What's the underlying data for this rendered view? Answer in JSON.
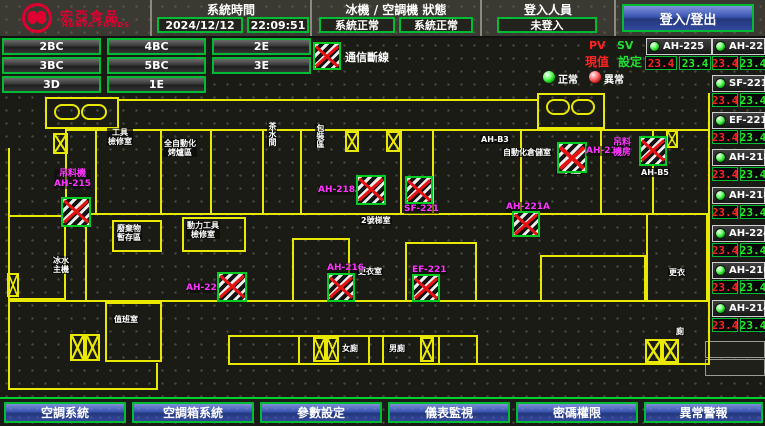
{
  "header": {
    "brand": {
      "name": "宏亞食品",
      "subname": "HUNYA FOODS"
    },
    "time": {
      "label": "系統時間",
      "date": "2024/12/12",
      "clock": "22:09:51"
    },
    "status": {
      "label": "冰機 / 空調機 狀態",
      "chiller": "系統正常",
      "ahu": "系統正常"
    },
    "login": {
      "label": "登入人員",
      "user": "未登入",
      "button_label": "登入/登出"
    }
  },
  "floor_buttons": [
    {
      "label": "2BC"
    },
    {
      "label": "4BC"
    },
    {
      "label": "2E"
    },
    {
      "label": "3BC"
    },
    {
      "label": "5BC"
    },
    {
      "label": "3E"
    },
    {
      "label": "3D"
    },
    {
      "label": "1E"
    }
  ],
  "comm_legend": {
    "label": "通信斷線"
  },
  "panel": {
    "pv": "PV",
    "sv": "SV",
    "pv_name": "現值",
    "sv_name": "設定",
    "normal": "正常",
    "abnormal": "異常",
    "units": [
      {
        "name": "AH-225",
        "pv": "23.4",
        "sv": "23.4"
      },
      {
        "name": "AH-221A",
        "pv": "23.4",
        "sv": "23.4"
      },
      {
        "name": "SF-221",
        "pv": "23.4",
        "sv": "23.4"
      },
      {
        "name": "EF-221",
        "pv": "23.4",
        "sv": "23.4"
      },
      {
        "name": "AH-218A",
        "pv": "23.4",
        "sv": "23.4"
      },
      {
        "name": "AH-218B",
        "pv": "23.4",
        "sv": "23.4"
      },
      {
        "name": "AH-224",
        "pv": "23.4",
        "sv": "23.4"
      },
      {
        "name": "AH-216",
        "pv": "23.4",
        "sv": "23.4"
      },
      {
        "name": "AH-214",
        "pv": "23.4",
        "sv": "23.4"
      }
    ]
  },
  "map": {
    "rooms": [
      {
        "text": "工具\n檢修室"
      },
      {
        "text": "全自動化\n烤爐區"
      },
      {
        "text": "茶水間"
      },
      {
        "text": "包裝區"
      },
      {
        "text": "AH-B3"
      },
      {
        "text": "自動化倉儲室"
      },
      {
        "text": "AH-B5"
      },
      {
        "text": "廢棄物\n暫存區"
      },
      {
        "text": "動力工具\n檢修室"
      },
      {
        "text": "冰水\n主機"
      },
      {
        "text": "值班室"
      },
      {
        "text": "2號梯室"
      },
      {
        "text": "更衣室"
      },
      {
        "text": "女廁"
      },
      {
        "text": "男廁"
      },
      {
        "text": "更衣"
      },
      {
        "text": "廁"
      },
      {
        "text": "工具室"
      }
    ],
    "devices": [
      {
        "label": "吊料機\nAH-215"
      },
      {
        "label": "AH-218A"
      },
      {
        "label": "SF-221"
      },
      {
        "label": "AH-218B"
      },
      {
        "label": "吊料\n機房"
      },
      {
        "label": "AH-221A"
      },
      {
        "label": "AH-224"
      },
      {
        "label": "AH-216"
      },
      {
        "label": "EF-221"
      }
    ]
  },
  "footer_buttons": [
    {
      "label": "空調系統"
    },
    {
      "label": "空調箱系統"
    },
    {
      "label": "參數設定"
    },
    {
      "label": "儀表監視"
    },
    {
      "label": "密碼權限"
    },
    {
      "label": "異常警報"
    }
  ],
  "colors": {
    "accent_green": "#00bb33",
    "line_yellow": "#e8e800",
    "alarm_red": "#e81111",
    "device_magenta": "#ff33ff",
    "button_blue": "#3a55b0",
    "brand_red": "#e00030"
  }
}
